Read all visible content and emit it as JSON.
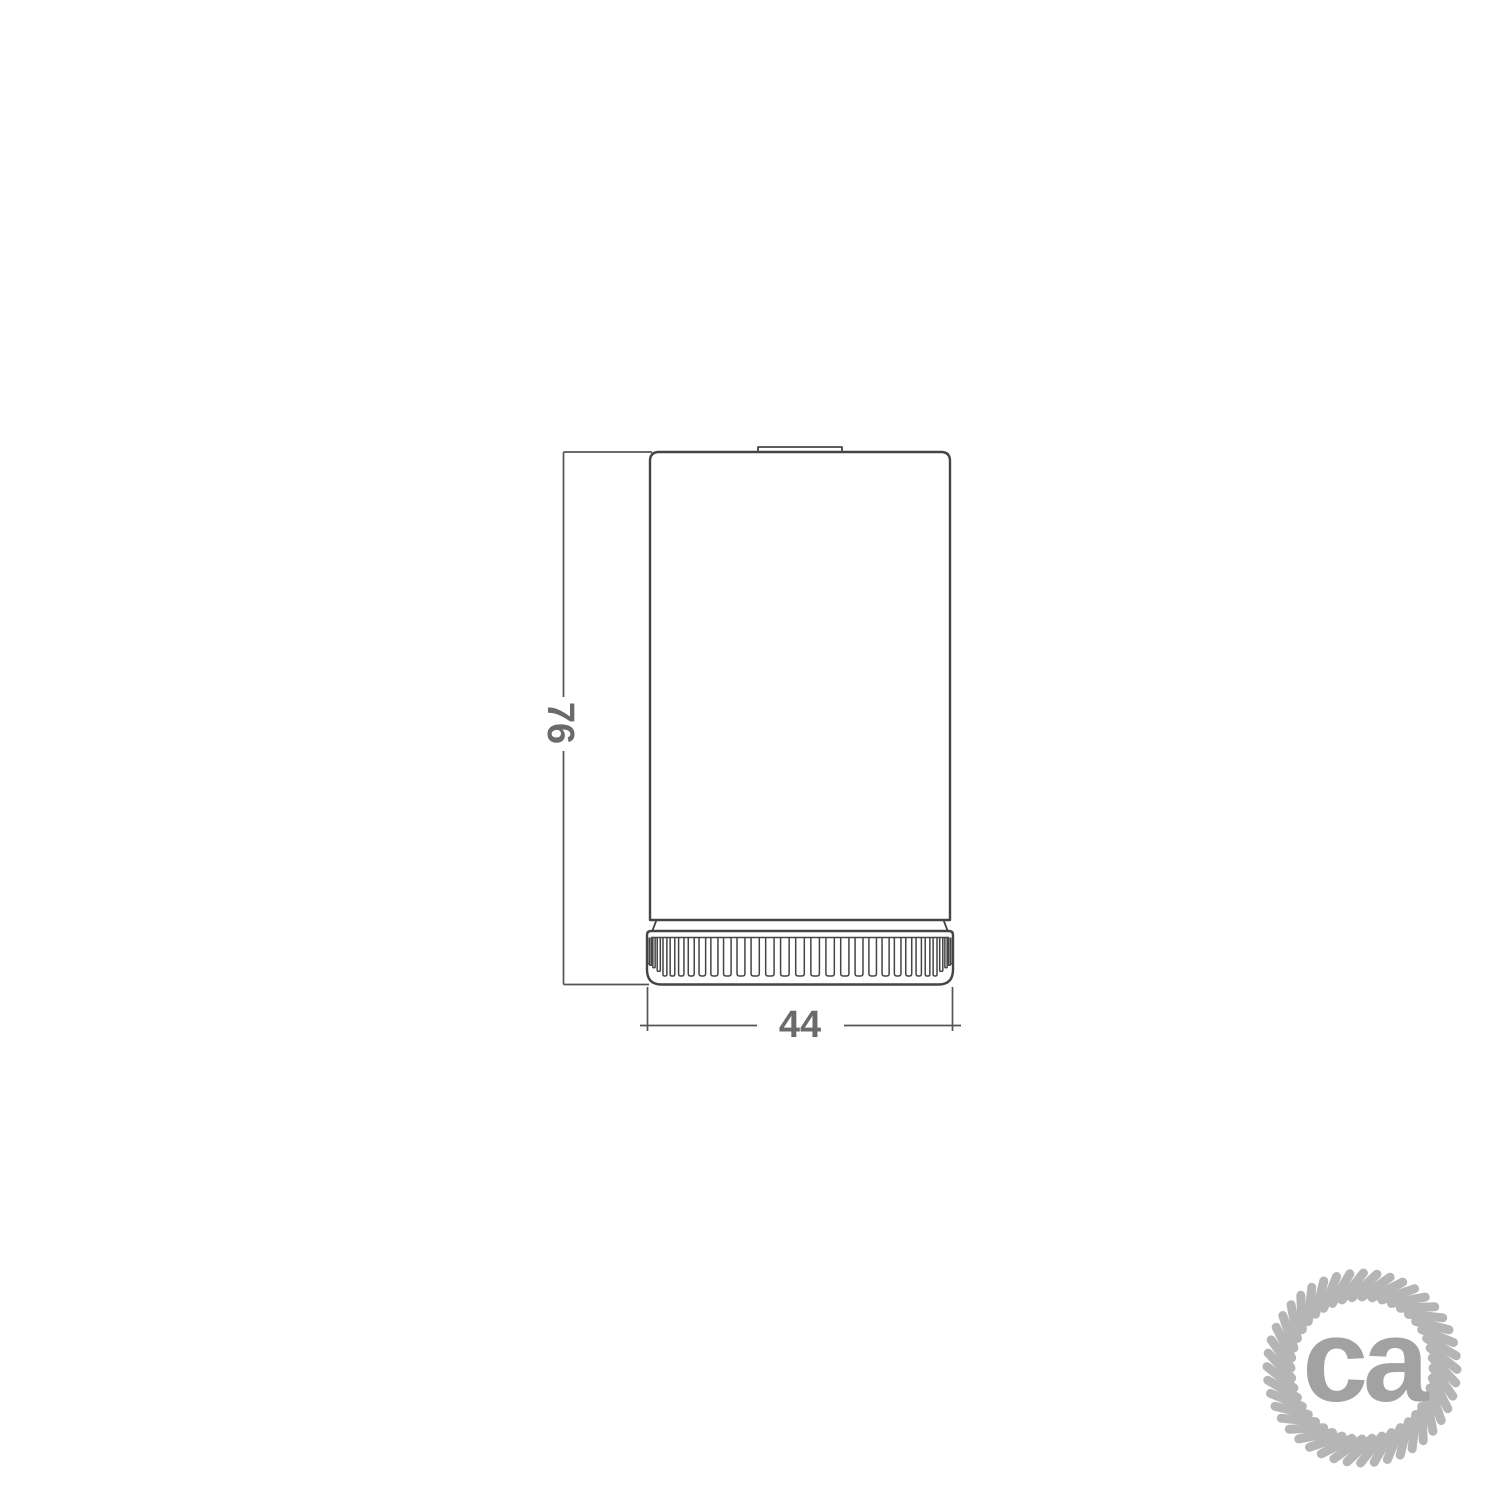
{
  "canvas": {
    "background": "#ffffff"
  },
  "drawing": {
    "title": "Cylindrical lamp holder cup with knurled ring — front elevation",
    "line_color": "#454545",
    "dimension_line_color": "#555555",
    "dimension_text_color": "#6a6a6a",
    "dimensions": {
      "height": {
        "value": "76",
        "orientation": "vertical",
        "measures": "overall height"
      },
      "diameter": {
        "value": "44",
        "orientation": "horizontal",
        "measures": "overall diameter"
      }
    },
    "knurl_rib_count": 31
  },
  "logo": {
    "text": "ca",
    "icon": "rope-circle-icon",
    "ring_color": "#b5b5b5",
    "text_color": "#a2a2a2",
    "strand_count": 44
  }
}
